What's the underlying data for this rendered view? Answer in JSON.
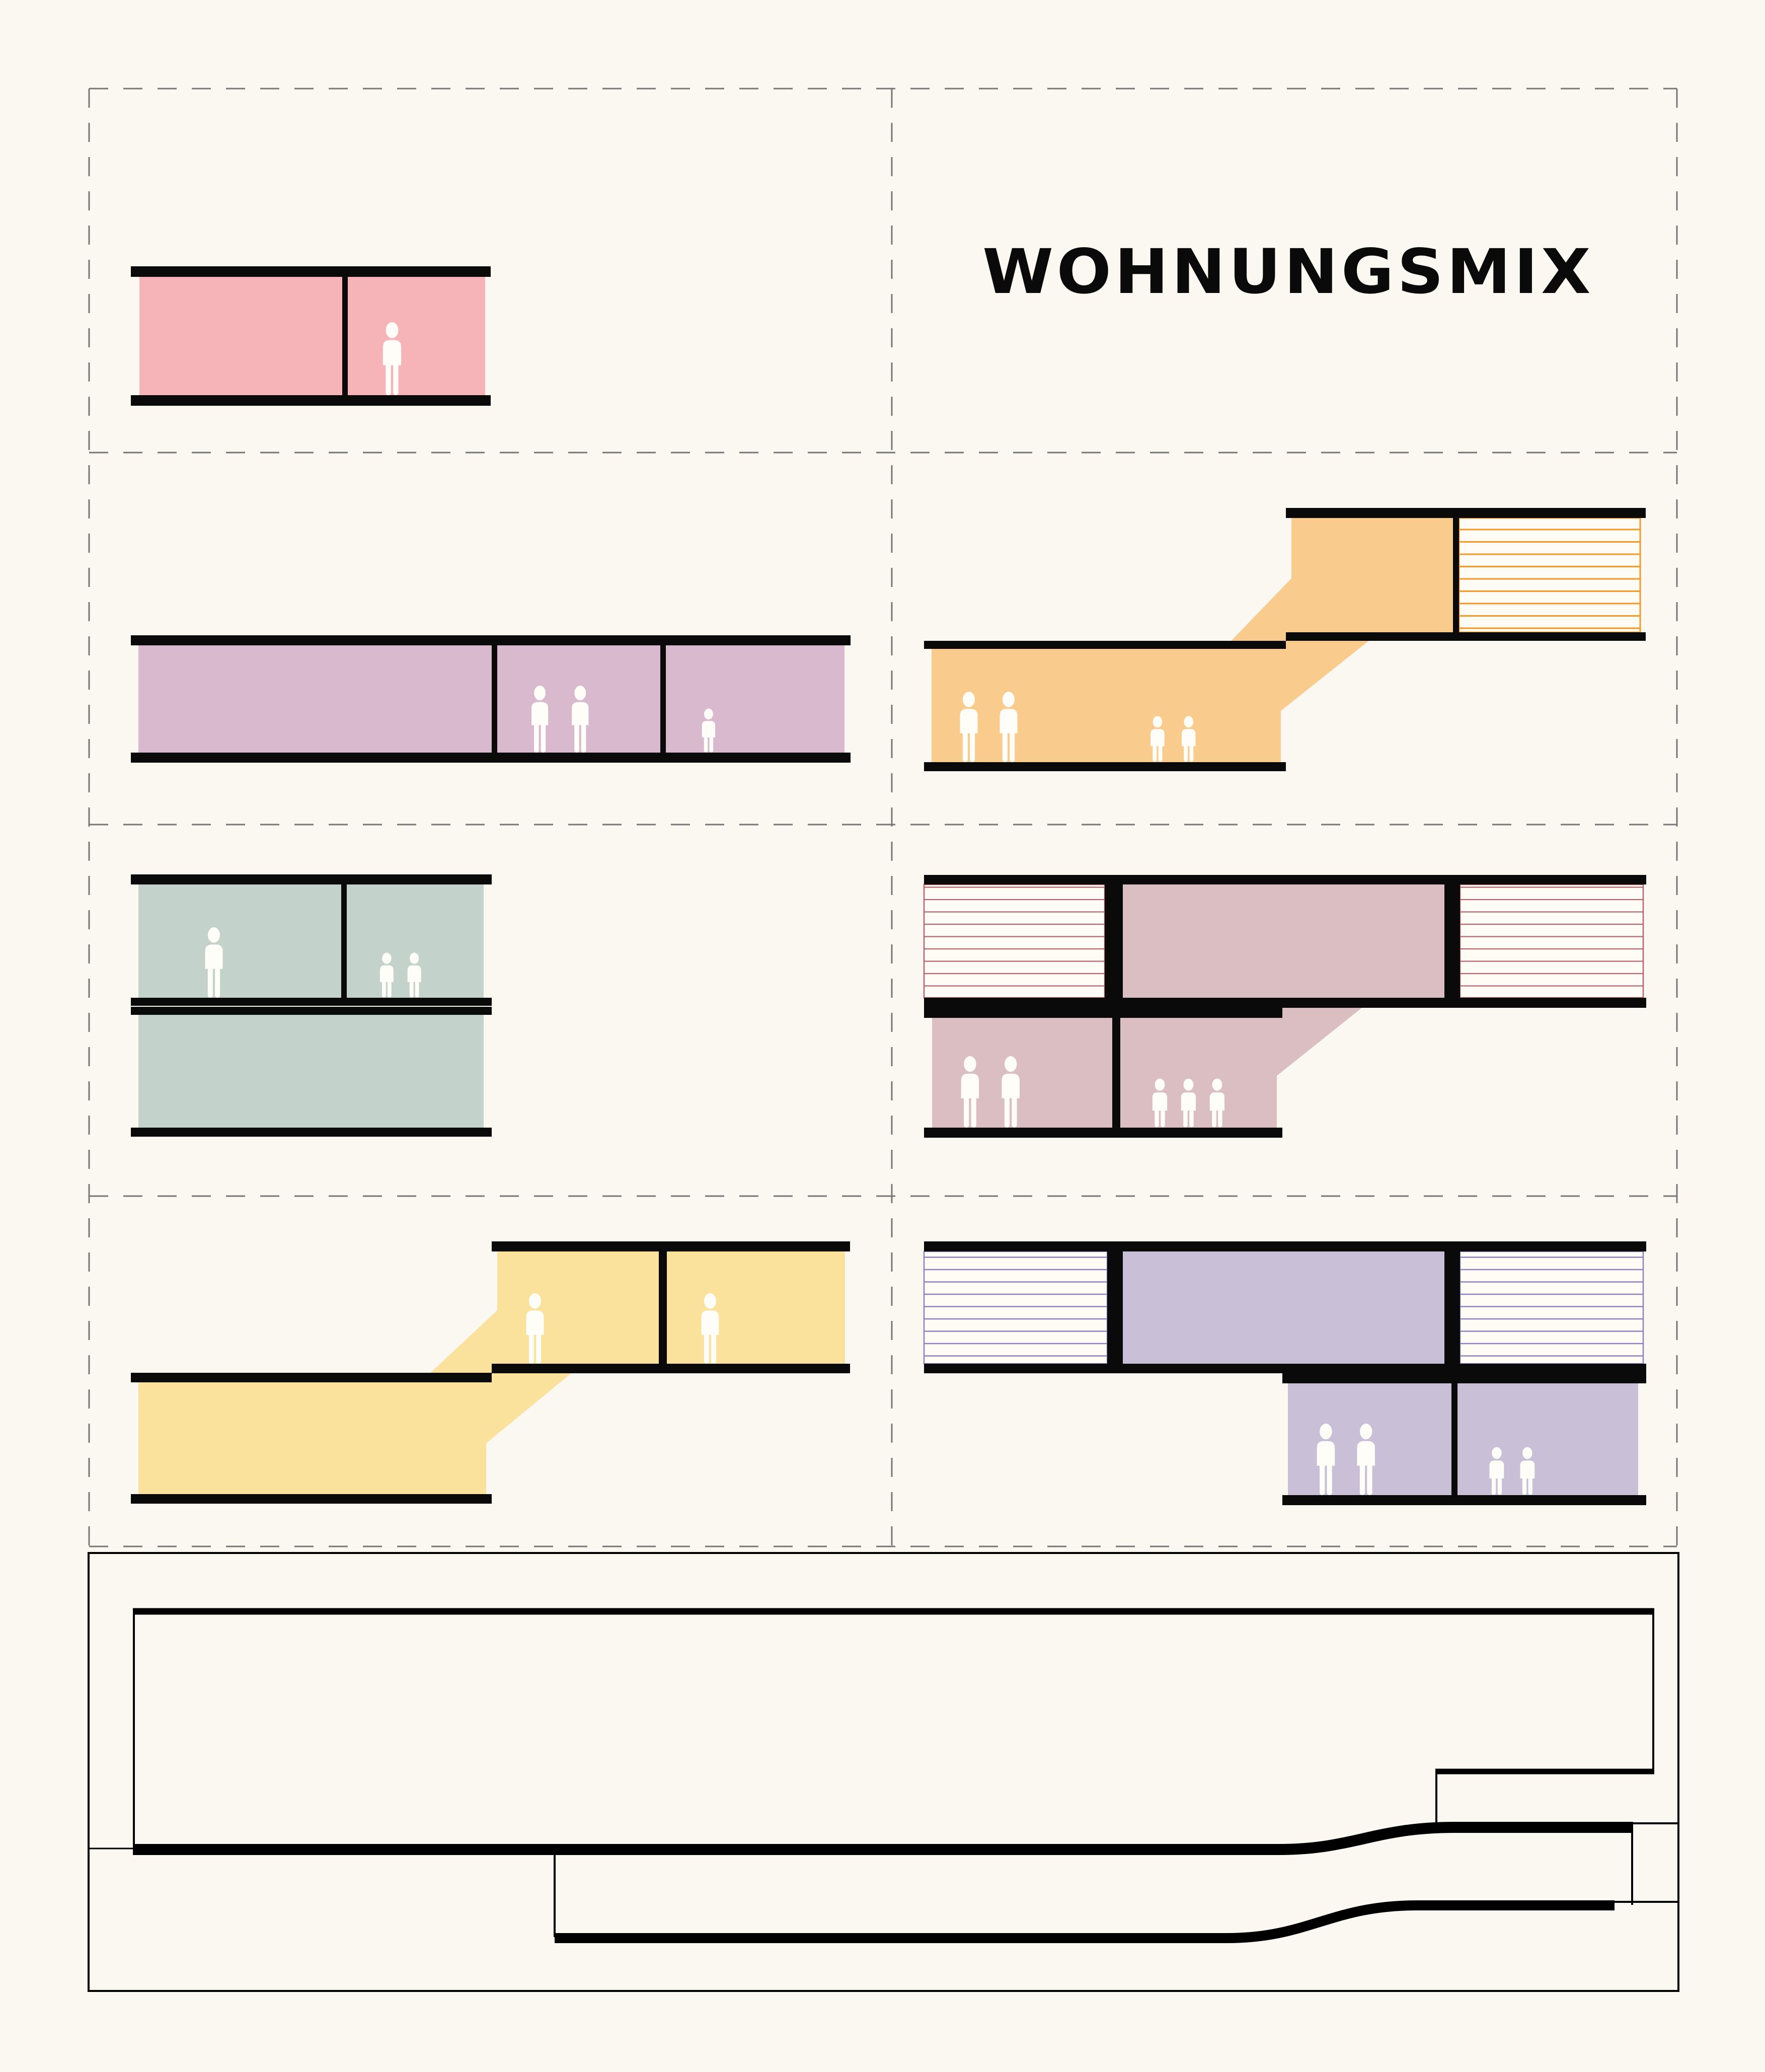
{
  "title": "WOHNUNGSMIX",
  "palette": {
    "background": "#FBF7F1",
    "slab": "#0A0A0A",
    "grid_line": "#777777",
    "figure": "#FFFDF8",
    "hatch_bg": "#FFFCF6",
    "section_line": "#000000",
    "title_color": "#0A0A0A"
  },
  "apartments": {
    "pink": {
      "color": "#F6B4B8",
      "units": 2,
      "occupants": {
        "unit_right": [
          "adult"
        ]
      }
    },
    "lilac": {
      "color": "#D8B9CE",
      "units": 3,
      "occupants": {
        "unit_middle": [
          "adult",
          "adult"
        ],
        "unit_right": [
          "child"
        ]
      }
    },
    "orange": {
      "color": "#F9CC8D",
      "hatch_color": "#F29A2E",
      "units": 2,
      "occupants": {
        "lower_adults": [
          "adult",
          "adult"
        ],
        "lower_children": [
          "child",
          "child"
        ]
      }
    },
    "green": {
      "color": "#C3D2CA",
      "units": 3,
      "occupants": {
        "upper_left": [
          "adult"
        ],
        "upper_right": [
          "child",
          "child"
        ]
      }
    },
    "mauve": {
      "color": "#DBBEC1",
      "hatch_color": "#B4646C",
      "units": 5,
      "occupants": {
        "lower_left": [
          "adult",
          "adult"
        ],
        "lower_right": [
          "child",
          "child",
          "child"
        ]
      }
    },
    "yellow": {
      "color": "#FAE29C",
      "units": 3,
      "occupants": {
        "upper_left": [
          "adult"
        ],
        "upper_right": [
          "adult"
        ]
      }
    },
    "purple": {
      "color": "#C9C0D8",
      "hatch_color": "#8F80BE",
      "units": 5,
      "occupants": {
        "lower_left": [
          "adult",
          "adult"
        ],
        "lower_right": [
          "child",
          "child"
        ]
      }
    }
  }
}
